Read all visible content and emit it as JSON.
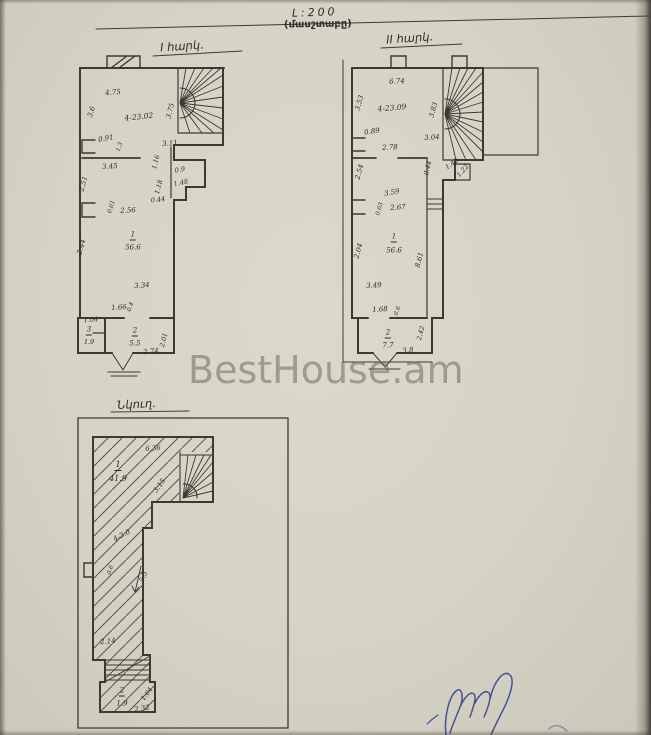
{
  "page": {
    "scale_label": "Լ:200",
    "scale_caption": "(մասշտաբը)",
    "watermark": "BestHouse.am",
    "paper_color": "#d6d3c6",
    "ink_color": "#3c3a32",
    "signature_color": "#2b3f8f"
  },
  "plans": {
    "floor1": {
      "title": "Ι հարկ.",
      "labels": [
        {
          "t": "4.75",
          "x": 113,
          "y": 93,
          "r": -5
        },
        {
          "t": "3.6",
          "x": 92,
          "y": 112,
          "r": -72
        },
        {
          "t": "4-23.02",
          "x": 139,
          "y": 117,
          "r": -6,
          "s": 7.5
        },
        {
          "t": "3.75",
          "x": 171,
          "y": 111,
          "r": -75
        },
        {
          "t": "3.11",
          "x": 170,
          "y": 144,
          "r": -4
        },
        {
          "t": "0.91",
          "x": 106,
          "y": 139,
          "r": -10
        },
        {
          "t": "1.3",
          "x": 120,
          "y": 147,
          "r": -72,
          "s": 6
        },
        {
          "t": "3.45",
          "x": 110,
          "y": 167,
          "r": -4
        },
        {
          "t": "2.51",
          "x": 84,
          "y": 184,
          "r": -75
        },
        {
          "t": "0.61",
          "x": 112,
          "y": 207,
          "r": -72,
          "s": 6
        },
        {
          "t": "2.56",
          "x": 128,
          "y": 211,
          "r": -3
        },
        {
          "t": "1.16",
          "x": 156,
          "y": 162,
          "r": -75,
          "s": 6.5
        },
        {
          "t": "0.9",
          "x": 180,
          "y": 170,
          "r": -12,
          "s": 6.5
        },
        {
          "t": "1.18",
          "x": 159,
          "y": 187,
          "r": -75,
          "s": 6.5
        },
        {
          "t": "1.48",
          "x": 181,
          "y": 183,
          "r": -12,
          "s": 6.5
        },
        {
          "t": "0.44",
          "x": 158,
          "y": 200,
          "r": -6,
          "s": 6.5
        },
        {
          "t": "1",
          "x": 133,
          "y": 236,
          "u": 1
        },
        {
          "t": "56.6",
          "x": 133,
          "y": 248
        },
        {
          "t": "2.44",
          "x": 82,
          "y": 247,
          "r": -75
        },
        {
          "t": "3.34",
          "x": 142,
          "y": 286,
          "r": -4
        },
        {
          "t": "1.66",
          "x": 119,
          "y": 308,
          "r": -4
        },
        {
          "t": "0.4",
          "x": 131,
          "y": 307,
          "r": -72,
          "s": 6
        },
        {
          "t": "1.04",
          "x": 91,
          "y": 320,
          "r": -4,
          "s": 6.5
        },
        {
          "t": "3",
          "x": 89,
          "y": 331,
          "u": 1,
          "s": 7
        },
        {
          "t": "1.9",
          "x": 89,
          "y": 342,
          "s": 6.5
        },
        {
          "t": "2",
          "x": 135,
          "y": 332,
          "u": 1
        },
        {
          "t": "5.5",
          "x": 135,
          "y": 344
        },
        {
          "t": "2.74",
          "x": 151,
          "y": 352,
          "r": -6
        },
        {
          "t": "2.01",
          "x": 164,
          "y": 340,
          "r": -75,
          "s": 6.5
        }
      ]
    },
    "floor2": {
      "title": "ΙΙ հարկ.",
      "labels": [
        {
          "t": "6.74",
          "x": 397,
          "y": 82,
          "r": -3
        },
        {
          "t": "3.53",
          "x": 360,
          "y": 103,
          "r": -75
        },
        {
          "t": "4-23.09",
          "x": 392,
          "y": 108,
          "r": -5,
          "s": 7.5
        },
        {
          "t": "3.83",
          "x": 434,
          "y": 110,
          "r": -75
        },
        {
          "t": "0.89",
          "x": 372,
          "y": 132,
          "r": -8
        },
        {
          "t": "2.78",
          "x": 390,
          "y": 148,
          "r": -3
        },
        {
          "t": "3.04",
          "x": 432,
          "y": 138,
          "r": -4
        },
        {
          "t": "0.44",
          "x": 428,
          "y": 168,
          "r": -75,
          "s": 6.5
        },
        {
          "t": "1.42",
          "x": 452,
          "y": 164,
          "r": -35,
          "s": 6.5
        },
        {
          "t": "1.22",
          "x": 463,
          "y": 171,
          "r": -50,
          "s": 6.5
        },
        {
          "t": "2.54",
          "x": 360,
          "y": 172,
          "r": -75
        },
        {
          "t": "3.59",
          "x": 392,
          "y": 193,
          "r": -10
        },
        {
          "t": "2.67",
          "x": 398,
          "y": 208,
          "r": -4
        },
        {
          "t": "0.63",
          "x": 380,
          "y": 209,
          "r": -75,
          "s": 6
        },
        {
          "t": "1",
          "x": 394,
          "y": 238,
          "u": 1
        },
        {
          "t": "56.6",
          "x": 394,
          "y": 251
        },
        {
          "t": "2.04",
          "x": 359,
          "y": 251,
          "r": -75
        },
        {
          "t": "8.61",
          "x": 420,
          "y": 260,
          "r": -75
        },
        {
          "t": "3.49",
          "x": 374,
          "y": 286,
          "r": -4
        },
        {
          "t": "1.68",
          "x": 380,
          "y": 310,
          "r": -4
        },
        {
          "t": "0.6",
          "x": 398,
          "y": 311,
          "r": -72,
          "s": 6
        },
        {
          "t": "2",
          "x": 388,
          "y": 334,
          "u": 1
        },
        {
          "t": "7.7",
          "x": 388,
          "y": 346
        },
        {
          "t": "3.8",
          "x": 408,
          "y": 351,
          "r": -6
        },
        {
          "t": "2.42",
          "x": 421,
          "y": 333,
          "r": -75,
          "s": 6.5
        }
      ]
    },
    "basement": {
      "title": "Նկուղ.",
      "labels": [
        {
          "t": "6.36",
          "x": 153,
          "y": 449,
          "r": -4
        },
        {
          "t": "1",
          "x": 118,
          "y": 466,
          "u": 1,
          "s": 8
        },
        {
          "t": "41.9",
          "x": 118,
          "y": 479,
          "s": 8
        },
        {
          "t": "3.15",
          "x": 160,
          "y": 486,
          "r": -55
        },
        {
          "t": "4-3.0",
          "x": 122,
          "y": 536,
          "r": -28
        },
        {
          "t": "0.6",
          "x": 111,
          "y": 570,
          "r": -75,
          "s": 6
        },
        {
          "t": "5.3",
          "x": 144,
          "y": 577,
          "r": -68
        },
        {
          "t": "2.14",
          "x": 108,
          "y": 642,
          "r": -6
        },
        {
          "t": "2",
          "x": 122,
          "y": 692,
          "u": 1
        },
        {
          "t": "1.9",
          "x": 122,
          "y": 704
        },
        {
          "t": "1.64",
          "x": 147,
          "y": 694,
          "r": -55,
          "s": 6.5
        },
        {
          "t": "2.32",
          "x": 142,
          "y": 709,
          "r": -8
        }
      ]
    }
  }
}
